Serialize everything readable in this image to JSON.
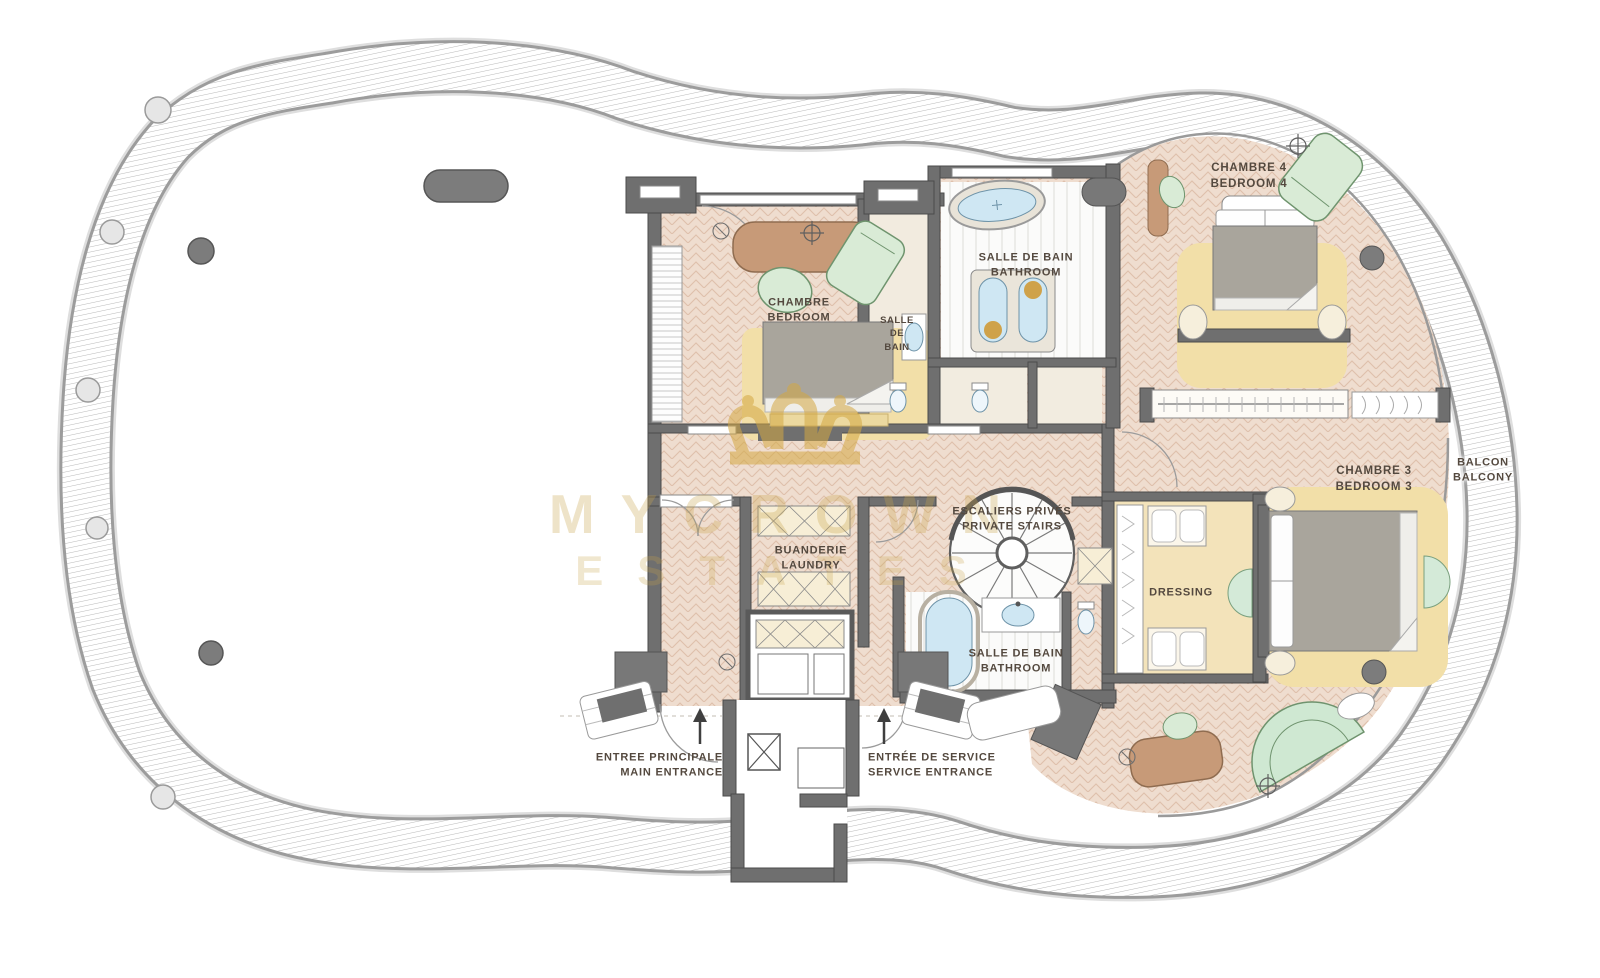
{
  "title": "Penthouse upper floor plan",
  "watermark": {
    "line1": "MYCROWN",
    "line2": "ESTATES"
  },
  "labels": {
    "bedroom2": {
      "fr": "CHAMBRE",
      "en": "BEDROOM"
    },
    "bath_small": {
      "l1": "SALLE",
      "l2": "DE",
      "l3": "BAIN"
    },
    "bath_main": {
      "fr": "SALLE DE BAIN",
      "en": "BATHROOM"
    },
    "bedroom4": {
      "fr": "CHAMBRE 4",
      "en": "BEDROOM 4"
    },
    "stairs": {
      "fr": "ESCALIERS PRIVÉS",
      "en": "PRIVATE STAIRS"
    },
    "laundry": {
      "fr": "BUANDERIE",
      "en": "LAUNDRY"
    },
    "bedroom3": {
      "fr": "CHAMBRE 3",
      "en": "BEDROOM 3"
    },
    "balcony": {
      "fr": "BALCON",
      "en": "BALCONY"
    },
    "dressing": {
      "label": "DRESSING"
    },
    "bath_lower": {
      "fr": "SALLE DE BAIN",
      "en": "BATHROOM"
    },
    "entrance_main": {
      "fr": "ENTREE PRINCIPALE",
      "en": "MAIN ENTRANCE"
    },
    "entrance_service": {
      "fr": "ENTRÉE DE SERVICE",
      "en": "SERVICE ENTRANCE"
    }
  },
  "colors": {
    "floor_herringbone": "#efddcf",
    "wall": "#6f6f6f",
    "rug": "#f2dfa8",
    "water_fixture": "#cfe7f3",
    "wood_furniture": "#c79a78",
    "green_furniture": "#d9ebd6",
    "closet_beige": "#f7eed6",
    "gold_watermark": "#d4a843",
    "label_text": "#54493f"
  }
}
